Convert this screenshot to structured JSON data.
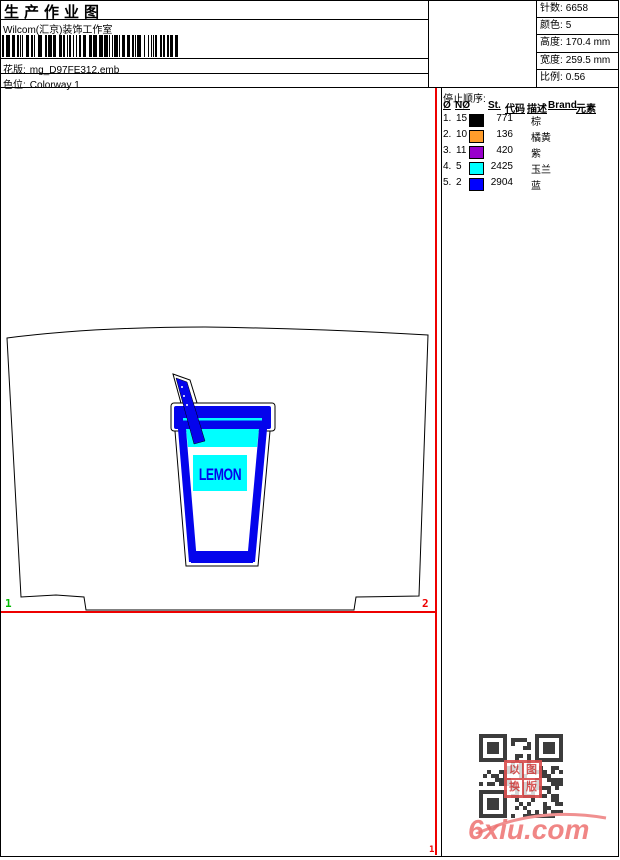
{
  "header": {
    "title": "生产作业图",
    "studio": "Wilcom(汇京)装饰工作室",
    "pattern_label": "花版:",
    "pattern_value": "mg_D97FE312.emb",
    "colorway_label": "色位:",
    "colorway_value": "Colorway 1"
  },
  "info": {
    "rows": [
      {
        "label": "针数:",
        "value": "6658"
      },
      {
        "label": "颜色:",
        "value": "5"
      },
      {
        "label": "高度:",
        "value": "170.4 mm"
      },
      {
        "label": "宽度:",
        "value": "259.5 mm"
      },
      {
        "label": "比例:",
        "value": "0.56"
      }
    ]
  },
  "stop_sequence": {
    "title": "停止顺序:",
    "columns": [
      "Ø",
      "NØ",
      "St.",
      "代码",
      "描述",
      "Brand",
      "元素"
    ],
    "rows": [
      {
        "seq": "1.",
        "needle": "15",
        "color": "#000000",
        "st": "771",
        "desc": "棕"
      },
      {
        "seq": "2.",
        "needle": "10",
        "color": "#FF9C2B",
        "st": "136",
        "desc": "橘黄"
      },
      {
        "seq": "3.",
        "needle": "11",
        "color": "#9900CC",
        "st": "420",
        "desc": "紫"
      },
      {
        "seq": "4.",
        "needle": "5",
        "color": "#00FFFF",
        "st": "2425",
        "desc": "玉兰"
      },
      {
        "seq": "5.",
        "needle": "2",
        "color": "#0000FF",
        "st": "2904",
        "desc": "蓝"
      }
    ]
  },
  "design": {
    "label_text": "LEMON",
    "markers": {
      "left": "1",
      "right": "2",
      "bottom": "1"
    },
    "colors": {
      "blue": "#0404EC",
      "cyan": "#00FFFF",
      "outline": "#000000",
      "guide_red": "#EE0000",
      "marker_green": "#00BB00"
    }
  },
  "footer": {
    "site": "6xiu.com",
    "stamp": [
      "以",
      "图",
      "换",
      "版"
    ]
  }
}
